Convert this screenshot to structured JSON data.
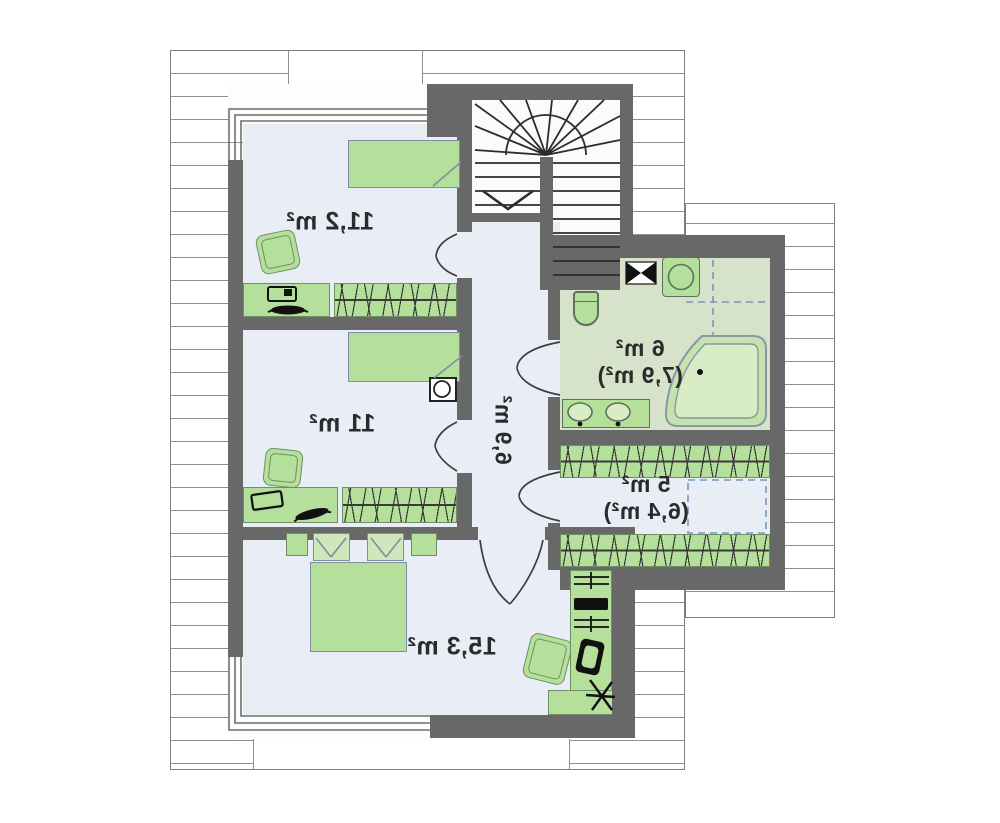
{
  "plan": {
    "type": "attic-floor-plan",
    "mirrored": true,
    "rooms": {
      "room_11_2": {
        "area_label": "11,2 m²"
      },
      "room_11": {
        "area_label": "11 m²"
      },
      "room_15_3": {
        "area_label": "15,3 m²"
      },
      "bathroom": {
        "area_label": "6 m²",
        "area_label_secondary": "(7,9 m²)"
      },
      "wardrobe": {
        "area_label": "5 m²",
        "area_label_secondary": "(6,4 m²)"
      },
      "hall": {
        "area_label": "6,9 m²"
      }
    },
    "colors": {
      "wall": "#686868",
      "floor": "#e8edf6",
      "bathfloor": "#d7e2ca",
      "furn": "#b5e09c",
      "roofline": "#8f8f8f",
      "text": "#2b2b2b"
    }
  }
}
